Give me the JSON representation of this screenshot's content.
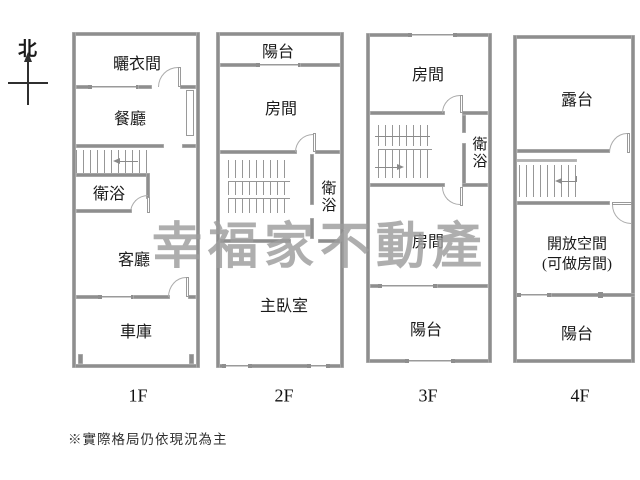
{
  "compass": {
    "label": "北"
  },
  "watermark": {
    "text": "幸福家不動產",
    "color": "#9d9d9d"
  },
  "footnote": "※實際格局仍依現況為主",
  "palette": {
    "wall": "#8e8e8e",
    "line": "#9a9a9a",
    "text": "#1a1a1a",
    "background": "#ffffff"
  },
  "floors": [
    {
      "label": "1F",
      "rooms": [
        "曬衣間",
        "餐廳",
        "衛浴",
        "客廳",
        "車庫"
      ]
    },
    {
      "label": "2F",
      "rooms": [
        "陽台",
        "房間",
        "衛浴",
        "主臥室"
      ]
    },
    {
      "label": "3F",
      "rooms": [
        "房間",
        "衛浴",
        "房間",
        "陽台"
      ]
    },
    {
      "label": "4F",
      "rooms": [
        "露台",
        "開放空間",
        "(可做房間)",
        "陽台"
      ]
    }
  ]
}
